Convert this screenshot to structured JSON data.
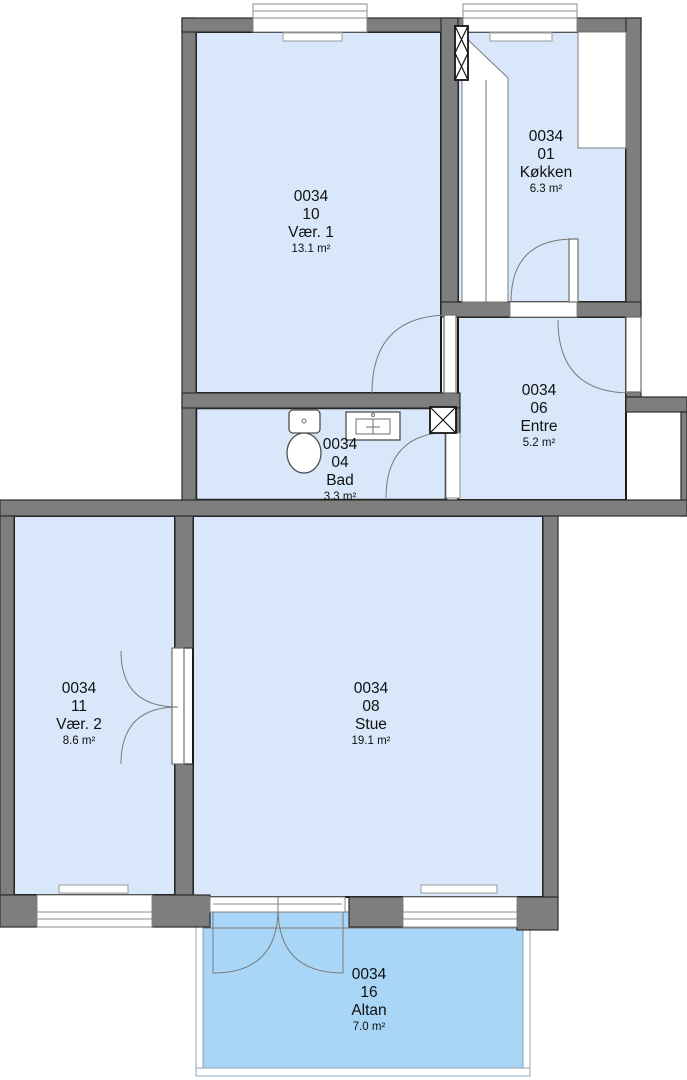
{
  "colors": {
    "wall": "#7e7e7e",
    "room": "#d8e8fa",
    "bath": "#8fc3ef",
    "balcony": "#a9d6f7",
    "outline": "#1c1c1c"
  },
  "rooms": {
    "vaer1": {
      "building": "0034",
      "number": "10",
      "name": "Vær. 1",
      "area": "13.1 m²"
    },
    "koekken": {
      "building": "0034",
      "number": "01",
      "name": "Køkken",
      "area": "6.3 m²"
    },
    "entre": {
      "building": "0034",
      "number": "06",
      "name": "Entre",
      "area": "5.2 m²"
    },
    "bad": {
      "building": "0034",
      "number": "04",
      "name": "Bad",
      "area": "3.3 m²"
    },
    "vaer2": {
      "building": "0034",
      "number": "11",
      "name": "Vær. 2",
      "area": "8.6 m²"
    },
    "stue": {
      "building": "0034",
      "number": "08",
      "name": "Stue",
      "area": "19.1 m²"
    },
    "altan": {
      "building": "0034",
      "number": "16",
      "name": "Altan",
      "area": "7.0 m²"
    }
  }
}
